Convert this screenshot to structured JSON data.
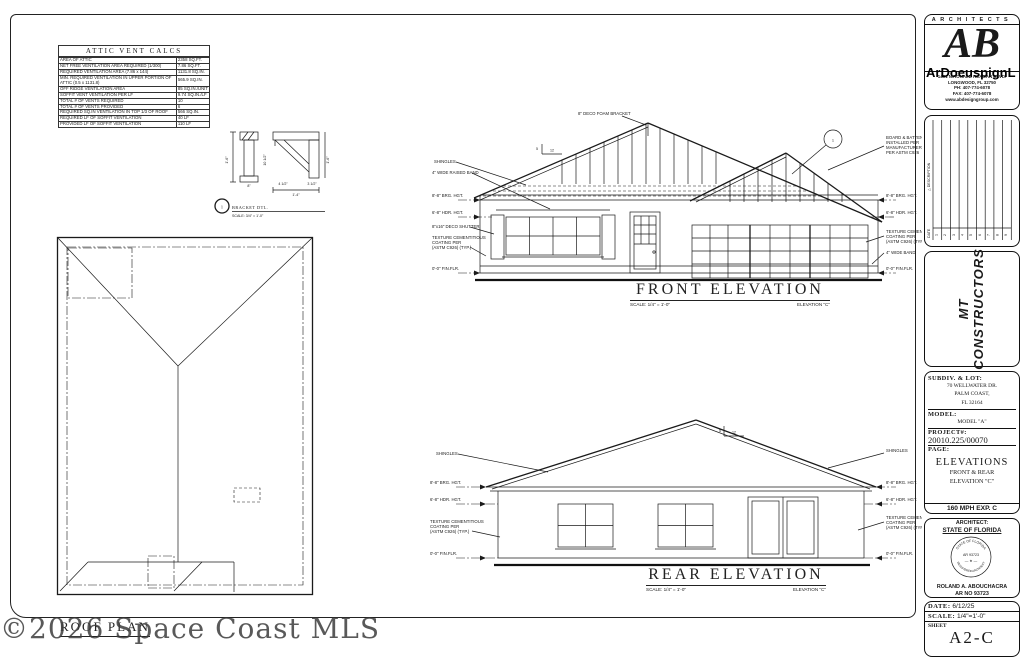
{
  "watermark": "©2026 Space Coast MLS",
  "attic": {
    "title": "ATTIC VENT CALCS",
    "rows": [
      {
        "label": "AREA OF ATTIC",
        "value": "2358 SQ.FT."
      },
      {
        "label": "NET FREE VENTILATION AREA REQUIRED (1/300)",
        "value": "7.86 SQ.FT."
      },
      {
        "label": "REQUIRED VENTILATION AREA (7.86 x 144)",
        "value": "1131.8 SQ.IN."
      },
      {
        "label": "MIN. REQUIRED VENTILATION IN UPPER PORTION OF ATTIC (0.5 x 1131.8)",
        "value": "565.9 SQ.IN."
      },
      {
        "label": "OFF RIDGE VENTILATION AREA",
        "value": "85 SQ.IN./UNIT"
      },
      {
        "label": "SOFFIT VENT VENTILATION PER LF",
        "value": "9.74 SQ.IN./LF"
      },
      {
        "label": "TOTAL # OF VENTS REQUIRED",
        "value": "10"
      },
      {
        "label": "TOTAL # OF VENTS PROVIDED",
        "value": "6"
      },
      {
        "label": "REQUIRED SQ.IN VENTILATION IN TOP 1/3 OF ROOF",
        "value": "566 SQ.IN."
      },
      {
        "label": "REQUIRED LF OF SOFFIT VENTILATION",
        "value": "40 LF"
      },
      {
        "label": "PROVIDED LF OF SOFFIT VENTILATION",
        "value": "110 LF"
      }
    ]
  },
  "bracket": {
    "number": "1",
    "title": "BRACKET  DTL.",
    "scale": "SCALE: 3/4\" = 1'-0\"",
    "dim_8": "8\"",
    "dim_16": "1'-6\"",
    "dim_105": "10 1/2\"",
    "dim_45": "4 1/2\"",
    "dim_35": "3 1/2\"",
    "dim_14": "1'-4\""
  },
  "roof_plan": {
    "title": "ROOF PLAN"
  },
  "common": {
    "brg": "8'-8\" BRG. HGT.",
    "hdr": "6'-8\" HDR. HGT.",
    "finflr": "0'-0\" FIN.FLR.",
    "shingles": "SHINGLES",
    "tex1": "TEXTURE CEMENTITIOUS",
    "tex2": "COATING PER",
    "tex3": "(ASTM C926) (TYP.)",
    "pitch_run": "12",
    "pitch_rise": "5"
  },
  "front": {
    "title": "FRONT  ELEVATION",
    "scale": "SCALE: 1/4\" = 1'-0\"",
    "elev": "ELEVATION \"C\"",
    "deco_bracket": "8\" DECO FOAM BRACKET",
    "raised_band": "4\" WIDE RAISED BAND",
    "shutter": "8\"x16\" DECO SHUTTER",
    "wide_band": "4\" WIDE BAND",
    "bb1": "BOARD & BATTEN SIDING",
    "bb2": "INSTALLED PER",
    "bb3": "MANUFACTURER'S SPECS",
    "bb4": "PER ASTM C926",
    "callout": "1"
  },
  "rear": {
    "title": "REAR  ELEVATION",
    "scale": "SCALE: 1/4\" = 1'-0\"",
    "elev": "ELEVATION \"C\""
  },
  "titleblock": {
    "architects": {
      "header": "ARCHITECTS",
      "logo": "AB",
      "overlay": "ArDoeuspignL",
      "addr1": "1461 N.RONALD REAGAN BLVD.",
      "addr2": "LONGWOOD, FL 32750",
      "addr3": "PH: 407-774-6078",
      "addr4": "FAX: 407-774-6078",
      "addr5": "www.abdesigngroup.com"
    },
    "revisions": {
      "desc_label": "△ DESCRIPTION",
      "date_label": "DATE",
      "numbers": [
        "1",
        "2",
        "3",
        "4",
        "5",
        "6",
        "7",
        "8",
        "9"
      ]
    },
    "company": {
      "line1": "MT",
      "line2": "CONSTRUCTORS"
    },
    "project": {
      "subdiv_label": "SUBDIV.  &  LOT:",
      "addr1": "70 WELLWATER DR.",
      "addr2": "PALM COAST,",
      "addr3": "FL 32164",
      "model_label": "MODEL:",
      "model_value": "MODEL \"A\"",
      "project_label": "PROJECT#:",
      "project_value": "20010.225/00070",
      "page_label": "PAGE:",
      "page_line1": "ELEVATIONS",
      "page_line2": "FRONT  &  REAR",
      "page_line3": "ELEVATION  \"C\"",
      "wind": "160 MPH EXP. C"
    },
    "seal": {
      "line1": "ARCHITECT:",
      "line2": "STATE OF FLORIDA",
      "arc_top": "STATE OF FLORIDA",
      "arc_bottom": "REGISTERED ARCHITECT",
      "center": "AR 93723",
      "name": "ROLAND A. ABOUCHACRA",
      "reg": "AR NO 93723"
    },
    "issue": {
      "date_label": "DATE:",
      "date_value": "6/12/25",
      "scale_label": "SCALE:",
      "scale_value": "1/4\"=1'-0\"",
      "sheet_label": "SHEET",
      "sheet_value": "A2-C"
    }
  }
}
